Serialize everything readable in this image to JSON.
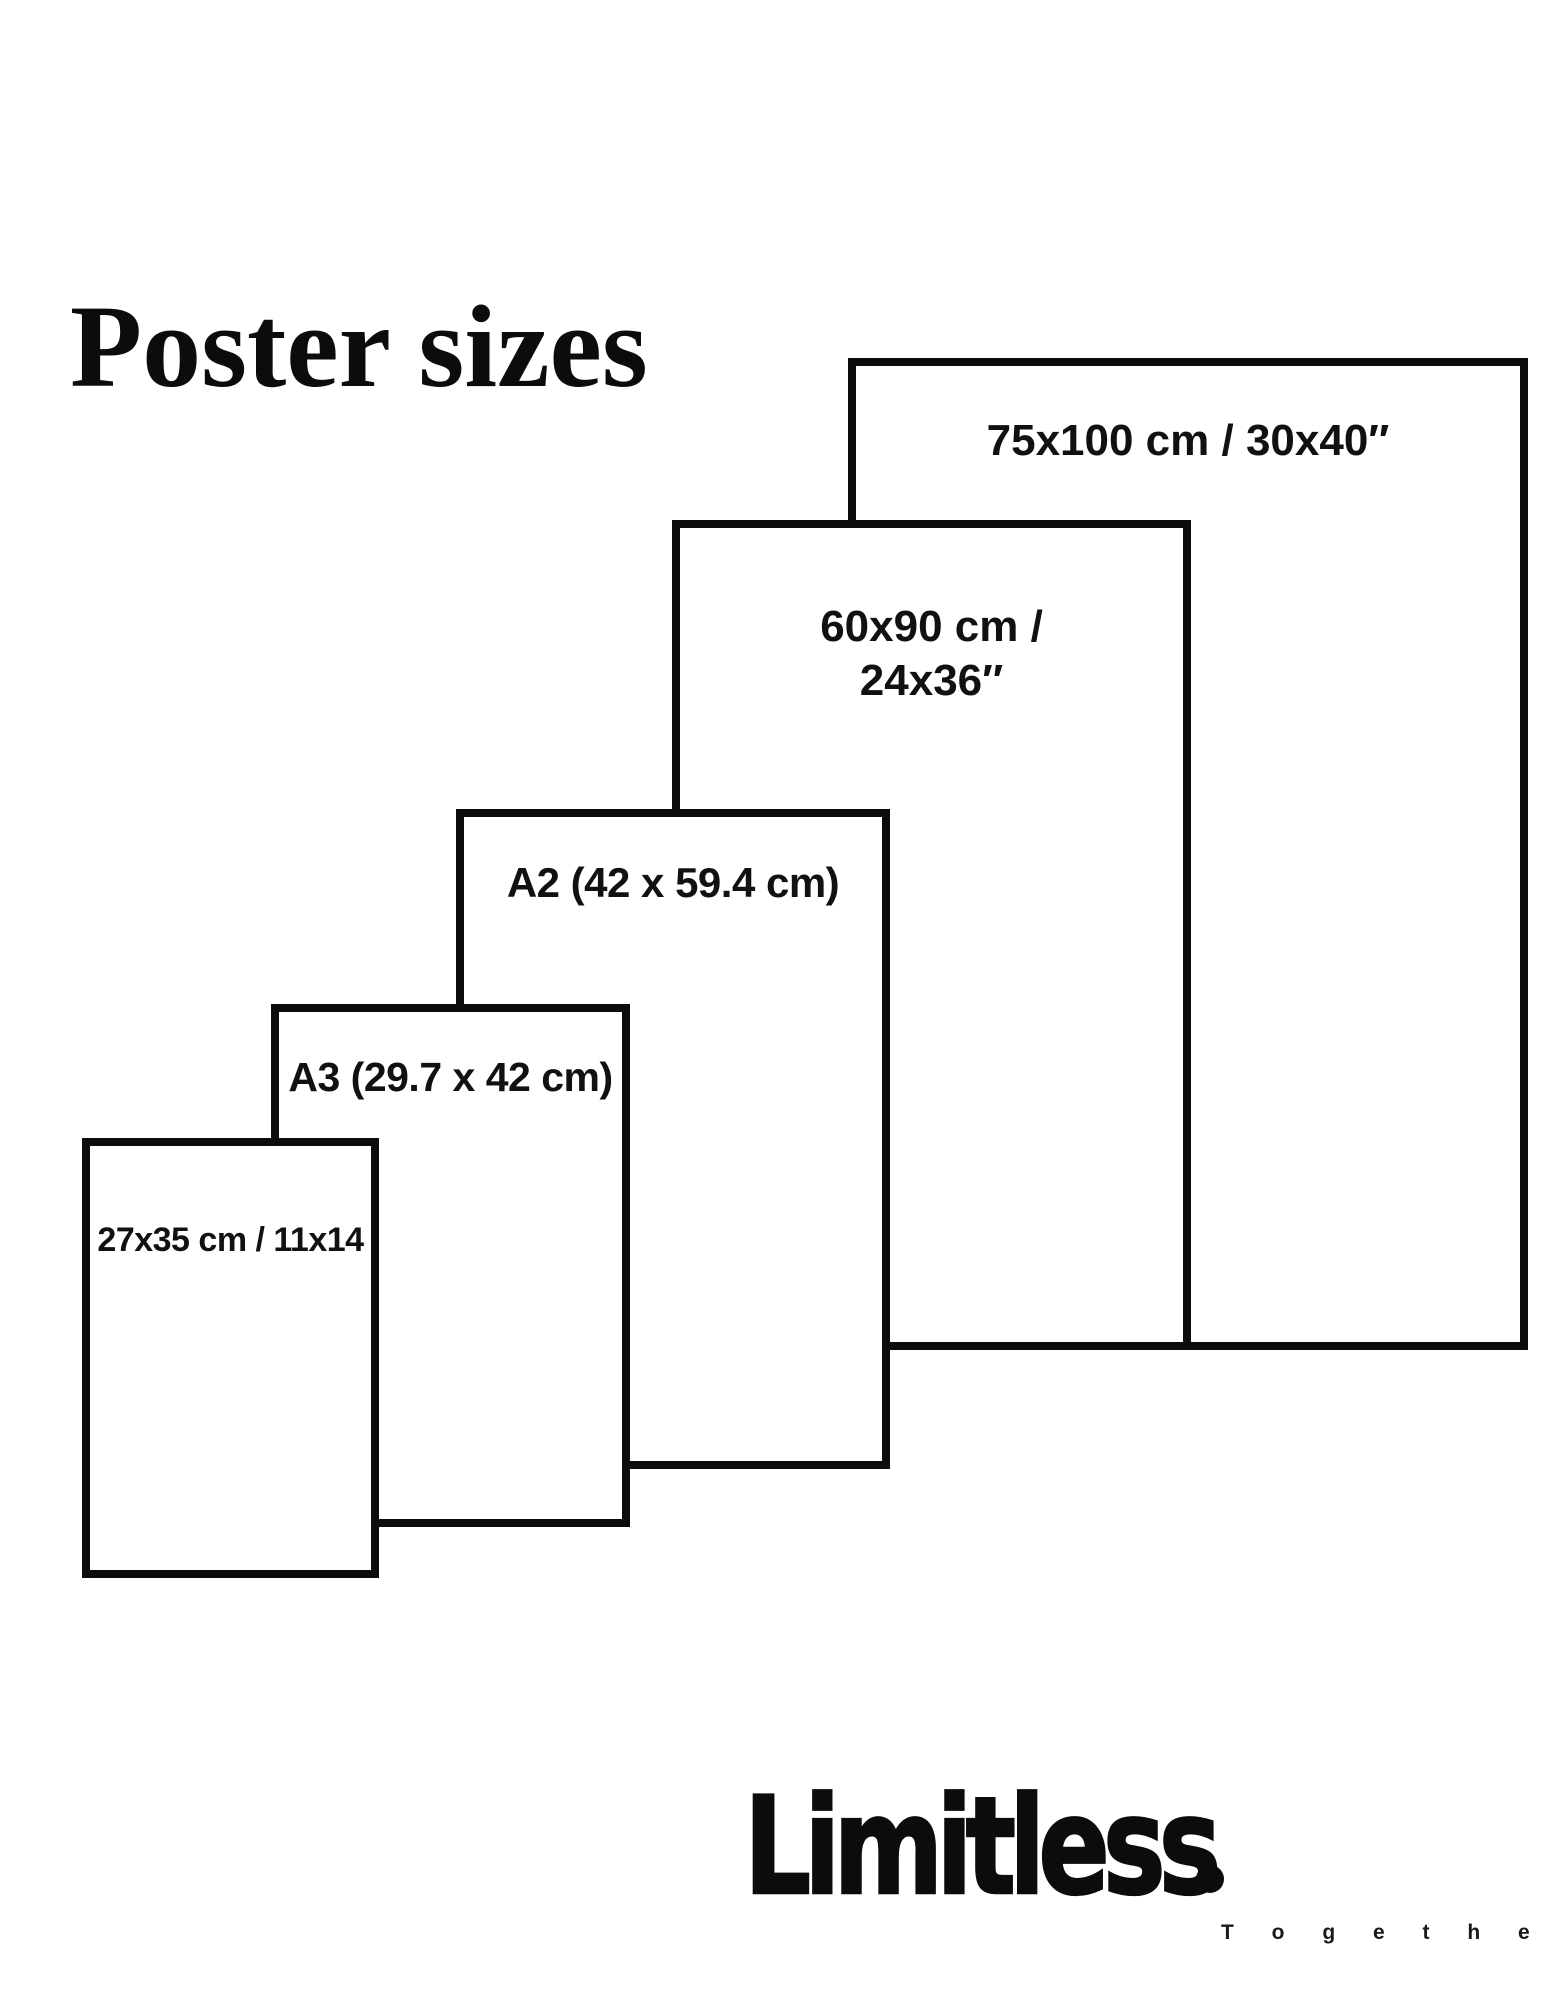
{
  "title": "Poster sizes",
  "diagram": {
    "description": "Nested outline rectangles comparing poster sizes, smallest at lower left to largest at upper right",
    "sizes": [
      {
        "name": "27x35",
        "label": "27x35 cm / 11x14"
      },
      {
        "name": "A3",
        "label": "A3 (29.7 x 42 cm)"
      },
      {
        "name": "A2",
        "label": "A2 (42 x 59.4 cm)"
      },
      {
        "name": "60x90",
        "label_line1": "60x90 cm /",
        "label_line2": "24x36″"
      },
      {
        "name": "75x100",
        "label": "75x100 cm / 30x40″"
      }
    ]
  },
  "brand": {
    "name": "Limitless",
    "tagline": "T o g e t h e r"
  },
  "colors": {
    "background": "#ffffff",
    "ink": "#0c0c0c"
  }
}
